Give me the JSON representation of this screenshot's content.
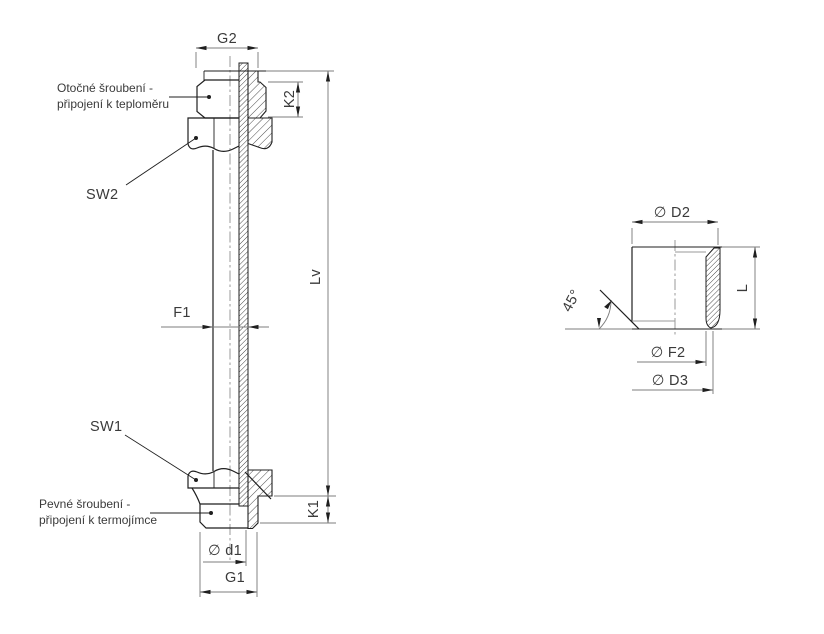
{
  "main_view": {
    "dimensions": {
      "g2": "G2",
      "k2": "K2",
      "f1": "F1",
      "lv": "Lv",
      "k1": "K1",
      "d1": "∅ d1",
      "g1": "G1"
    },
    "labels": {
      "sw2": "SW2",
      "sw1": "SW1"
    },
    "annotations": {
      "swivel": {
        "line1": "Otočné šroubení -",
        "line2": "připojení k teploměru"
      },
      "fixed": {
        "line1": "Pevné šroubení -",
        "line2": "připojení k termojímce"
      }
    }
  },
  "detail_view": {
    "dimensions": {
      "d2": "∅ D2",
      "chamfer_angle": "45°",
      "l": "L",
      "f2": "∅ F2",
      "d3": "∅ D3"
    }
  },
  "colors": {
    "object_line": "#1f1f1f",
    "dimension_line": "#7d7d7d",
    "centerline": "#8f8f8f",
    "text": "#3a3a3a",
    "background": "#ffffff"
  }
}
